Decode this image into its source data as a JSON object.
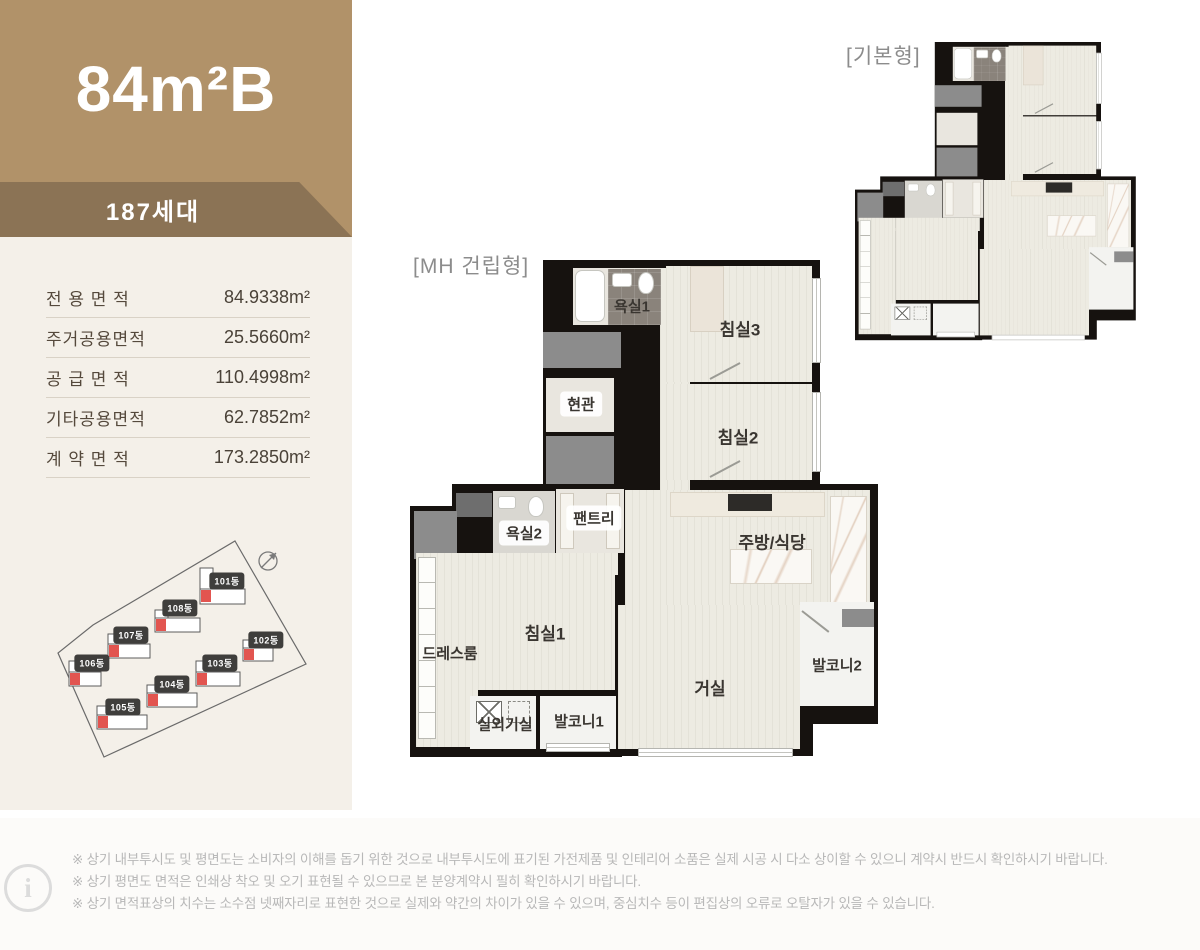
{
  "unit": {
    "title": "84m²B",
    "households": "187세대"
  },
  "area_table": {
    "rows": [
      {
        "label": "전 용 면 적",
        "value": "84.9338m²"
      },
      {
        "label": "주거공용면적",
        "value": "25.5660m²"
      },
      {
        "label": "공 급 면 적",
        "value": "110.4998m²"
      },
      {
        "label": "기타공용면적",
        "value": "62.7852m²"
      },
      {
        "label": "계 약 면 적",
        "value": "173.2850m²"
      }
    ]
  },
  "site_map": {
    "buildings": [
      {
        "label": "101동"
      },
      {
        "label": "102동"
      },
      {
        "label": "103동"
      },
      {
        "label": "104동"
      },
      {
        "label": "105동"
      },
      {
        "label": "106동"
      },
      {
        "label": "107동"
      },
      {
        "label": "108동"
      }
    ]
  },
  "plans": {
    "mh_title": "[MH 건립형]",
    "basic_title": "[기본형]",
    "rooms": {
      "bath1": "욕실1",
      "bed3": "침실3",
      "entrance": "현관",
      "bed2": "침실2",
      "pantry": "팬트리",
      "bath2": "욕실2",
      "kitchen": "주방/식당",
      "dressroom": "드레스룸",
      "bed1": "침실1",
      "living": "거실",
      "balcony2": "발코니2",
      "outdoor": "실외기실",
      "balcony1": "발코니1"
    }
  },
  "footer": {
    "notes": [
      "※ 상기 내부투시도 및 평면도는 소비자의 이해를 돕기 위한 것으로 내부투시도에 표기된 가전제품 및 인테리어 소품은 실제 시공 시 다소 상이할 수 있으니 계약시 반드시 확인하시기 바랍니다.",
      "※ 상기 평면도 면적은 인쇄상 착오 및 오기 표현될 수 있으므로 본 분양계약시 필히 확인하시기 바랍니다.",
      "※ 상기 면적표상의 치수는 소수점 넷째자리로 표현한 것으로 실제와 약간의 차이가 있을 수 있으며, 중심치수 등이 편집상의 오류로 오탈자가 있을 수 있습니다."
    ]
  },
  "colors": {
    "header_brown": "#b19269",
    "band_brown": "#8b7355",
    "panel_cream": "#f4f0e9",
    "wall_black": "#16120f",
    "marker_red": "#e25550"
  }
}
